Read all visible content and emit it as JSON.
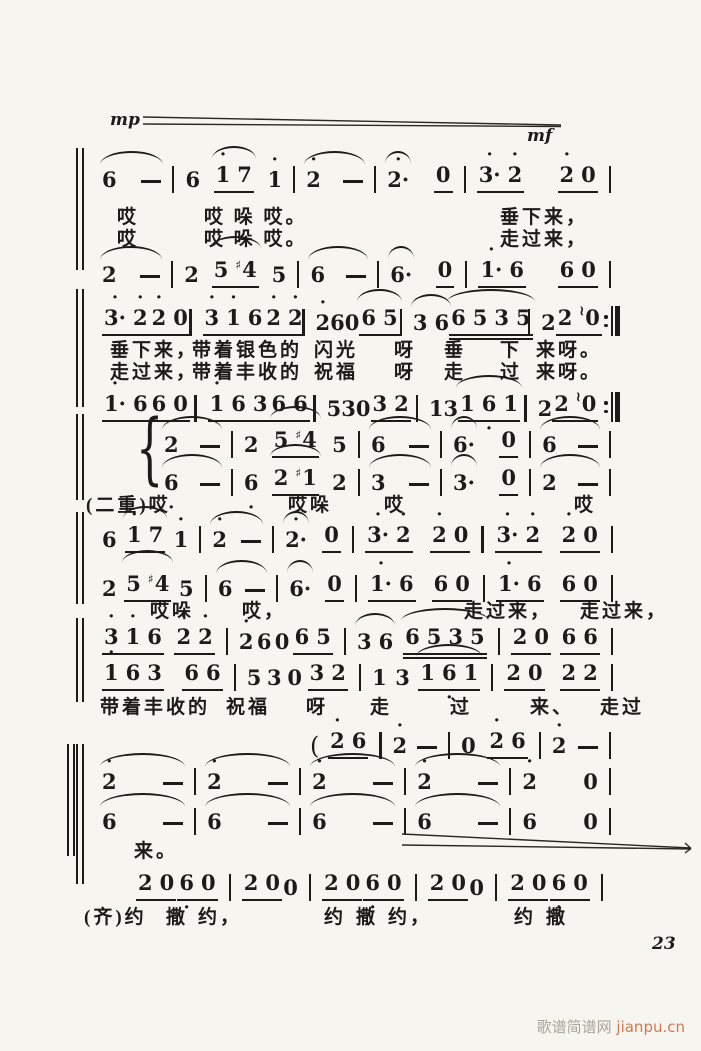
{
  "dynamics": {
    "mp": "mp",
    "mf": "mf"
  },
  "page": {
    "number": "23"
  },
  "watermark": {
    "site": "歌谱简谱网",
    "domain": "jianpu.cn"
  },
  "systems": [
    {
      "voices": [
        {
          "bars": "+ 6 - / 6 +[1' 7] 1' / + 2' - / +(2'.) [0] / [3'. 2'] [2' 0]",
          "end": "bar"
        },
        {
          "bars": "+ 2 - / 2 +[5 #4] 5 / + 6 - / +(6.) [0] / [1'. 6] [6 0]",
          "end": "bar"
        }
      ],
      "lyrics": [
        [
          "哎",
          "哎 哚 哎。",
          "垂下来，"
        ],
        [
          "哎",
          "哎 哚 哎。",
          "走过来，"
        ]
      ]
    },
    {
      "voices": [
        {
          "bars": "[3'. 2'] [2' 0] / [3' 1' 6] [2' 2'] / 2' 6 0 +[6 5] / +(3 6) +[[6 5 3 5]] / 2 [2 ~0]",
          "end": "repeat"
        },
        {
          "bars": "[1'. 6] [6 0] / [1' 6 3] [6 6] / 5 3 0 [3 2] / 1 3 +[1 6, 1] / 2 [2 ~0]",
          "end": "repeat"
        }
      ],
      "lyrics": [
        [
          "垂下来，",
          "带着银色的",
          "闪光",
          "呀",
          "垂",
          "下",
          "来呀。"
        ],
        [
          "走过来，",
          "带着丰收的",
          "祝福",
          "呀",
          "走",
          "过",
          "来呀。"
        ]
      ]
    },
    {
      "voices": [
        {
          "bars": "+ 2 - / 2 +[5 #4] 5 / + 6 - / +(6.) [0] / + 6 -",
          "end": "bar"
        },
        {
          "bars": "+ 6, - / 6, +[2 #1] 2 / + 3 - / +(3.) [0] / + 2 -",
          "end": "bar"
        }
      ],
      "lyrics": [
        [
          "(二重)哎",
          "哎哚",
          "哎",
          "哎"
        ]
      ]
    },
    {
      "voices": [
        {
          "bars": "6 +[1' 7] 1' / + 2' - / +(2'.) [0] / [3'. 2'] [2' 0] / [3'. 2'] [2' 0]",
          "end": "bar"
        },
        {
          "bars": "2 +[5 #4] 5 / + 6 - / +(6.) [0] / [1'. 6] [6 0] / [1'. 6] [6 0]",
          "end": "bar"
        }
      ],
      "lyrics": [
        [
          "哎哚",
          "哎，",
          "走过来，",
          "走过来，"
        ]
      ]
    },
    {
      "voices": [
        {
          "bars": "[3' 1' 6] [2' 2'] / 2' 6 0 [6 5] / +(3 6) +[[6 5 3 5]] / [2 0] [6 6]",
          "end": "bar"
        },
        {
          "bars": "[1' 6 3] [6 6] / 5 3 0 [3 2] / 1 3 +[1 6, 1] / [2 0] [2 2]",
          "end": "bar"
        }
      ],
      "lyrics": [
        [
          "带着丰收的",
          "祝福",
          "呀",
          "走",
          "过",
          "来、",
          "走过"
        ]
      ]
    },
    {
      "voices": [
        {
          "bars": "( [2' 6] / 2' - / 0 [2' 6] / 2' -",
          "end": "bar"
        },
        {
          "bars": "+ 2' - / + 2' - / + 2' - / + 2' - / 2' 0",
          "end": "bar"
        },
        {
          "bars": "+ 6 - / + 6 - / + 6 - / + 6 - / 6 0",
          "end": "bar"
        }
      ],
      "lyrics": [
        [
          "来。"
        ]
      ]
    },
    {
      "voices": [
        {
          "bars": "[2 0] [6, 0] / [2 0] 0 / [2 0] [6, 0] / [2 0] 0 / [2 0] [6, 0]",
          "end": "bar"
        }
      ],
      "lyrics": [
        [
          "(齐)约",
          "撒",
          "约，",
          "约",
          "撒",
          "约，",
          "约",
          "撒"
        ]
      ]
    }
  ]
}
